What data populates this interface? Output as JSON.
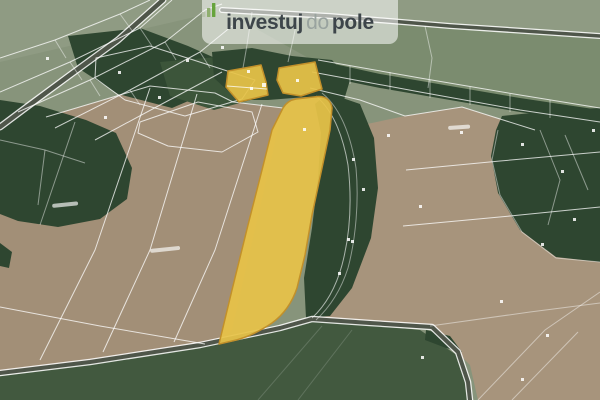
{
  "theme": {
    "highlight-fill": "#e7c348",
    "highlight-stroke": "#c2902a",
    "base-green": "#87947b",
    "top-green": "#8f9b83",
    "wedge-green": "#7b8c6f",
    "brown-a": "#a28f77",
    "brown-b": "#a7947c",
    "forest": "#2e4630",
    "forest-light": "#3c553a",
    "bottom-green": "#42593f",
    "road-dark": "#4f564a",
    "cadastral-line": "rgba(255,255,255,0.75)",
    "logo-dark": "#3d454a",
    "logo-light": "#99a39f",
    "logo-green": "#67a43c",
    "logo-bg": "rgba(255,255,255,0.55)"
  },
  "logo": {
    "part1": "investuj",
    "part2": "do",
    "part3": "pole",
    "icon": "growth-bars-icon"
  },
  "map": {
    "kind": "aerial-cadastral-map",
    "highlighted_parcel_count": 3,
    "highlighted_parcels": [
      {
        "id": "parcel-small-west"
      },
      {
        "id": "parcel-small-east"
      },
      {
        "id": "parcel-main-strip"
      }
    ],
    "highlight_color": "#e7c348"
  }
}
